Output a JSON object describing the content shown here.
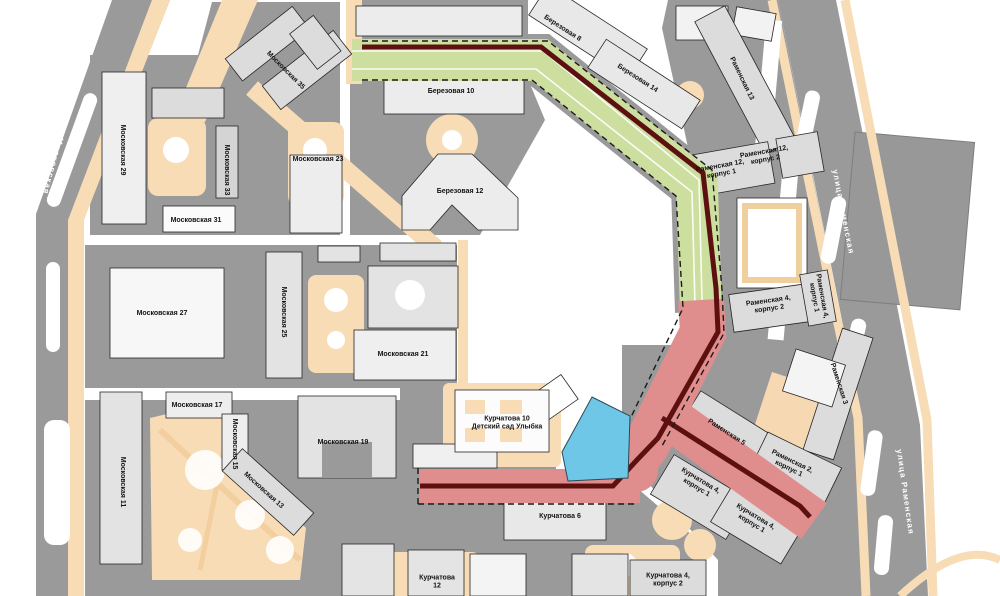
{
  "map": {
    "type": "site-plan",
    "streets": [
      {
        "label": "улица Московская"
      },
      {
        "label": "улица Московская"
      },
      {
        "label": "улица Раменская"
      },
      {
        "label": "улица Раменская"
      }
    ],
    "buildings": [
      {
        "label": "Московская 35"
      },
      {
        "label": "Московская 29"
      },
      {
        "label": "Московская 23"
      },
      {
        "label": "Московская 33"
      },
      {
        "label": "Московская 31"
      },
      {
        "label": "Березовая 8"
      },
      {
        "label": "Березовая 14"
      },
      {
        "label": "Березовая 10"
      },
      {
        "label": "Березовая 12"
      },
      {
        "label": "Раменская 13"
      },
      {
        "label": "Раменская 12,\nкорпус 1"
      },
      {
        "label": "Раменская 12,\nкорпус 2"
      },
      {
        "label": "Раменская 4,\nкорпус 2"
      },
      {
        "label": "Раменская 4,\nкорпус 1"
      },
      {
        "label": "Раменская 3"
      },
      {
        "label": "Раменская 5"
      },
      {
        "label": "Раменская 2,\nкорпус 1"
      },
      {
        "label": "Курчатова 4,\nкорпус 1"
      },
      {
        "label": "Курчатова 4,\nкорпус 1"
      },
      {
        "label": "Курчатова 4,\nкорпус 2"
      },
      {
        "label": "Курчатова 6"
      },
      {
        "label": "Курчатова 10\nДетский сад Улыбка"
      },
      {
        "label": "Курчатова\n12"
      },
      {
        "label": "Московская 27"
      },
      {
        "label": "Московская 25"
      },
      {
        "label": "Московская 21"
      },
      {
        "label": "Московская 19"
      },
      {
        "label": "Московская 17"
      },
      {
        "label": "Московская 15"
      },
      {
        "label": "Московская 13"
      },
      {
        "label": "Московская 11"
      }
    ],
    "overlays": {
      "green_route_color": "#ccdf9f",
      "red_route_color": "#e08d8d",
      "route_edge_color": "#5c1110",
      "selected_plot_color": "#6fc7e8",
      "block_color": "#9a9a9a",
      "path_color": "#f7dcb6"
    }
  }
}
